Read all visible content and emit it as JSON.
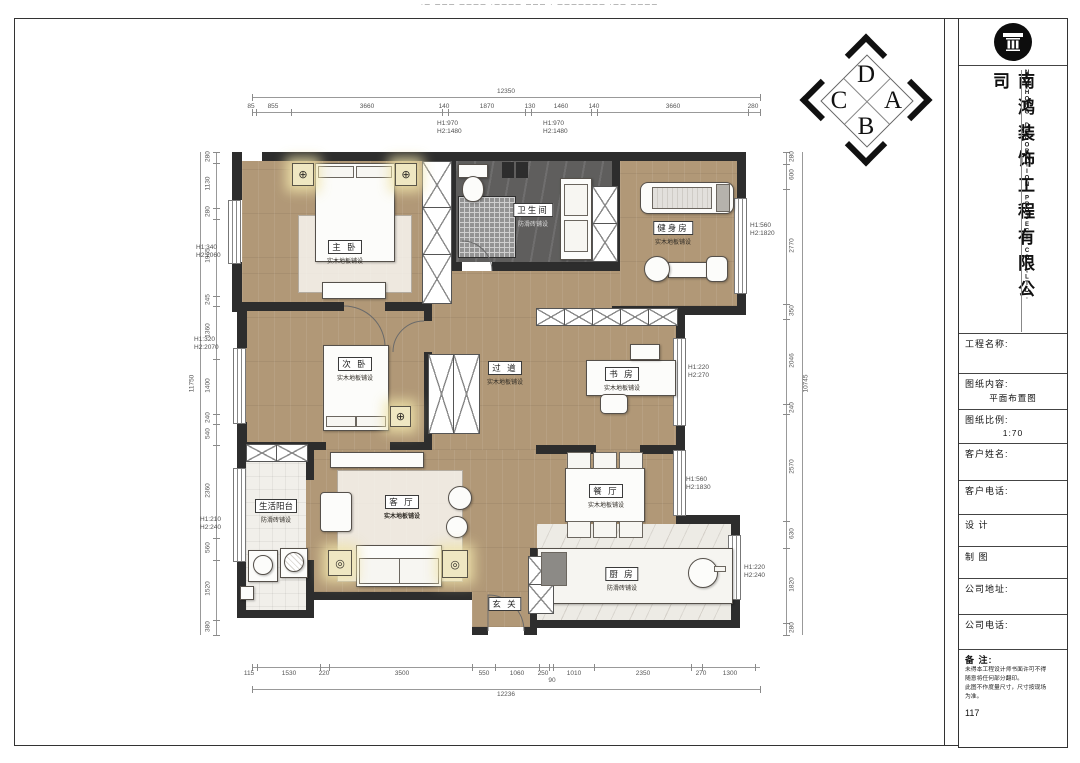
{
  "sheet": {
    "top_note": "·— ——— ———— ·———— ——— · ——————— ·—— ————"
  },
  "company": {
    "name_cn": "南鸿装饰工程有限公司",
    "name_en": "NANHONG DECORATION PROJECT CO.,LTD."
  },
  "titleblock": {
    "fields": [
      {
        "label": "工程名称:",
        "value": ""
      },
      {
        "label": "图纸内容:",
        "value": "平面布置图"
      },
      {
        "label": "图纸比例:",
        "value": "1:70"
      },
      {
        "label": "客户姓名:",
        "value": ""
      },
      {
        "label": "客户电话:",
        "value": ""
      },
      {
        "label": "设  计",
        "value": ""
      },
      {
        "label": "制  图",
        "value": ""
      },
      {
        "label": "公司地址:",
        "value": ""
      },
      {
        "label": "公司电话:",
        "value": ""
      }
    ],
    "remarks_label": "备  注:",
    "remarks_lines": [
      "未得本工程设计师书面许可不得",
      "随意将任何部分翻印。",
      "此图不作度量尺寸，尺寸按现场",
      "为准。"
    ],
    "page_number": "117"
  },
  "compass": {
    "top": "D",
    "right": "A",
    "bottom": "B",
    "left": "C"
  },
  "icons": {
    "light_cross": "⊕",
    "light_ring": "◎"
  },
  "rooms": {
    "master": {
      "name": "主 卧",
      "floor": "实木地板铺设"
    },
    "bathroom": {
      "name": "卫生间",
      "floor": "防滑砖铺设"
    },
    "gym": {
      "name": "健身房",
      "floor": "实木地板铺设"
    },
    "second": {
      "name": "次 卧",
      "floor": "实木地板铺设"
    },
    "study": {
      "name": "书 房",
      "floor": "实木地板铺设"
    },
    "corridor": {
      "name": "过 道",
      "floor": "实木地板铺设"
    },
    "living": {
      "name": "客 厅",
      "floor": "实木地板铺设"
    },
    "dining": {
      "name": "餐 厅",
      "floor": "实木地板铺设"
    },
    "balcony": {
      "name": "生活阳台",
      "floor": "防滑砖铺设"
    },
    "kitchen": {
      "name": "厨 房",
      "floor": "防滑砖铺设"
    },
    "entry": {
      "name": "玄 关",
      "floor": ""
    }
  },
  "dims": {
    "top": {
      "total": "12350",
      "values": [
        "85",
        "855",
        "3660",
        "140",
        "1870",
        "130",
        "1460",
        "140",
        "3660",
        "280"
      ]
    },
    "bottom": {
      "total": "12236",
      "values": [
        "115",
        "1530",
        "220",
        "3500",
        "550",
        "1060",
        "250",
        "90",
        "1010",
        "2350",
        "270",
        "1300"
      ]
    },
    "left": {
      "total": "11750",
      "values": [
        "280",
        "1130",
        "280",
        "1965",
        "245",
        "1360",
        "1400",
        "240",
        "540",
        "2360",
        "560",
        "1520",
        "380"
      ]
    },
    "right": {
      "total": "10745",
      "values": [
        "280",
        "600",
        "2770",
        "350",
        "2046",
        "240",
        "2570",
        "630",
        "1820",
        "280"
      ]
    }
  },
  "annotations": [
    "H1:970\nH2:1480",
    "H1:970\nH2:1480",
    "H1:340\nH2:2060",
    "H1:320\nH2:2070",
    "H1:210\nH2:240",
    "H1:560\nH2:1820",
    "H1:220\nH2:270",
    "H1:560\nH2:1830",
    "H1:220\nH2:240"
  ]
}
